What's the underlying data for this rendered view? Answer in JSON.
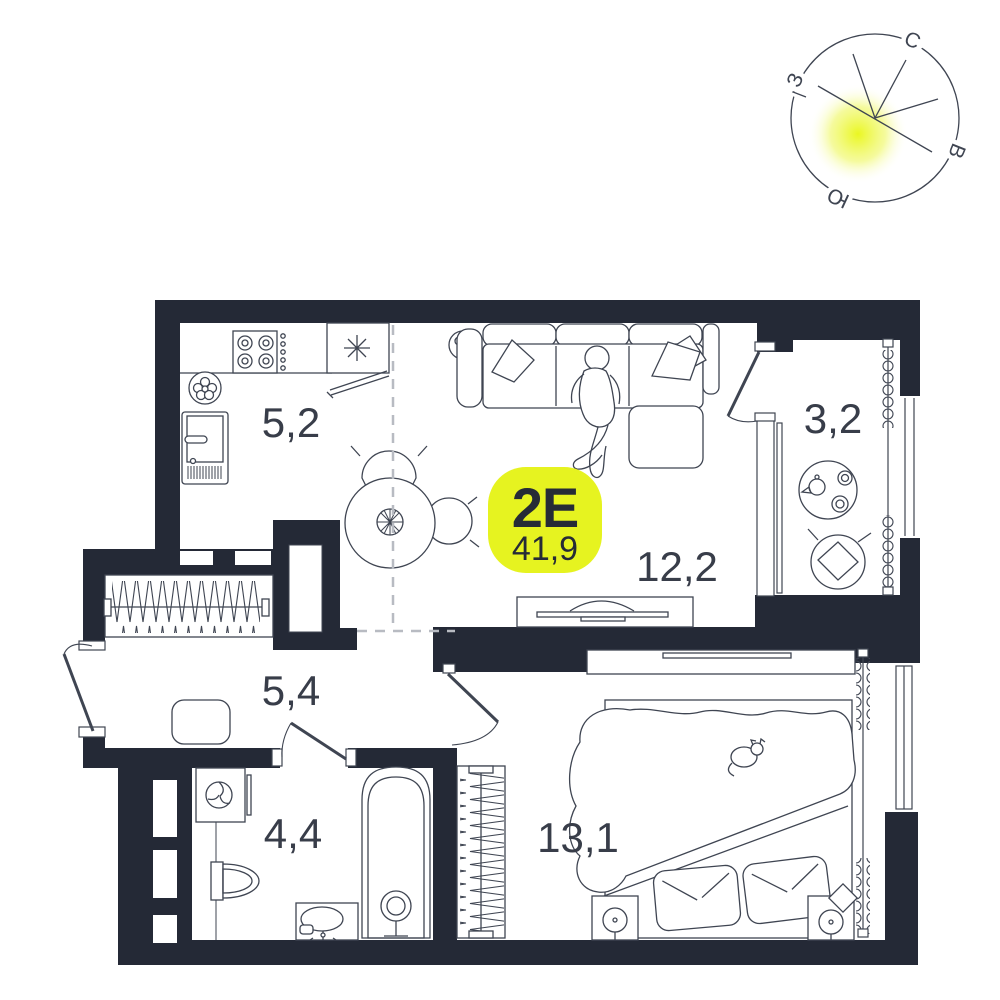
{
  "floorplan": {
    "unit": {
      "type_label": "2Е",
      "area_label": "41,9"
    },
    "rooms": {
      "kitchen": {
        "area": "5,2"
      },
      "living": {
        "area": "12,2"
      },
      "loggia": {
        "area": "3,2"
      },
      "hall": {
        "area": "5,4"
      },
      "bathroom": {
        "area": "4,4"
      },
      "bedroom": {
        "area": "13,1"
      }
    },
    "compass": {
      "north": "С",
      "east": "В",
      "south": "Ю",
      "west": "З"
    },
    "colors": {
      "wall": "#242936",
      "furniture_line": "#3f4552",
      "dashed_zone_line": "#b8bbc2",
      "badge": "#e6f320",
      "sun_glow": "#e9f616",
      "label_text": "#383d49"
    }
  }
}
